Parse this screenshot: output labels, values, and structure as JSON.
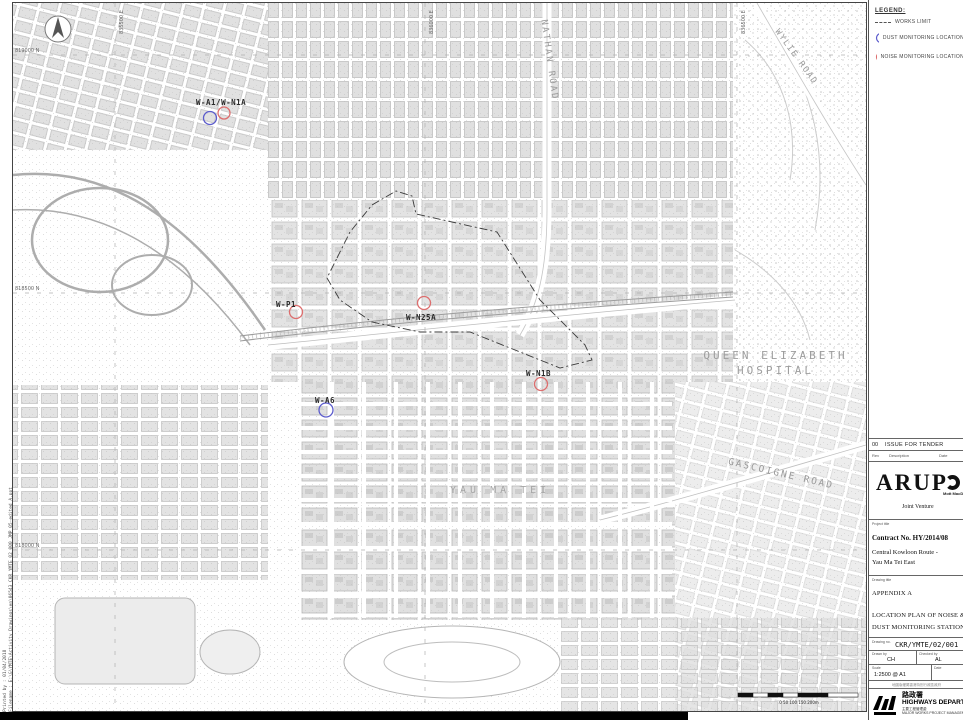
{
  "legend": {
    "title": "LEGEND:",
    "works_limit": "WORKS LIMIT",
    "dust": "DUST MONITORING LOCATION",
    "noise": "NOISE MONITORING LOCATION",
    "dust_color": "#5b5bcc",
    "noise_color": "#dd6e6e"
  },
  "map": {
    "stations": [
      {
        "label": "W-A1/W-N1A"
      },
      {
        "label": "W-P1"
      },
      {
        "label": "W-N25A"
      },
      {
        "label": "W-N1B"
      },
      {
        "label": "W-A6"
      }
    ],
    "places": {
      "nathan": "NATHAN ROAD",
      "wylie": "WYLIE ROAD",
      "qeh1": "QUEEN ELIZABETH",
      "qeh2": "HOSPITAL",
      "gascoigne": "GASCOIGNE ROAD",
      "yaumatei": "YAU MA TEI"
    },
    "grid": {
      "n1": "819000 N",
      "n2": "818500 N",
      "n3": "818000 N",
      "e1": "835500 E",
      "e2": "836000 E",
      "e3": "836500 E"
    },
    "scalebar": "0    50    100    150    200m"
  },
  "margin": {
    "printed": "Printed by :  01/04/2018",
    "file": "Filename : E:\\G\\YMTE\\Activity Drawings\\en\\06543_CKR_YMTE_02_000_JMP_05-edited A.ppt"
  },
  "title_block": {
    "rev_no": "00",
    "rev_desc": "ISSUE FOR TENDER",
    "rev_col_no": "Rev",
    "rev_col_desc": "Description",
    "rev_col_date": "Date",
    "arup": "ARUP",
    "partner": "Mott MacDonald",
    "joint_venture": "Joint Venture",
    "project_label": "Project title",
    "contract": "Contract No. HY/2014/08",
    "project1": "Central Kowloon Route -",
    "project2": "Yau Ma Tei East",
    "drawing_label": "Drawing title",
    "appendix": "APPENDIX A",
    "title1": "LOCATION PLAN OF NOISE &",
    "title2": "DUST MONITORING STATIONS",
    "drawing_no_label": "Drawing no.",
    "drawing_no": "CKR/YMTE/02/001",
    "drawn_label": "Drawn by",
    "drawn": "CH",
    "checked_label": "Checked by",
    "checked": "AL",
    "scale_label": "Scale",
    "scale": "1:2500 @ A1",
    "date_label": "Date",
    "date": "",
    "stamp": "地圖版權屬香港特別行政區政府",
    "dept_cn": "路政署",
    "dept_en": "HIGHWAYS DEPARTMENT",
    "dept_sub_cn": "主要工程管理處",
    "dept_sub_en": "MAJOR WORKS PROJECT MANAGEMENT OFFICE"
  }
}
